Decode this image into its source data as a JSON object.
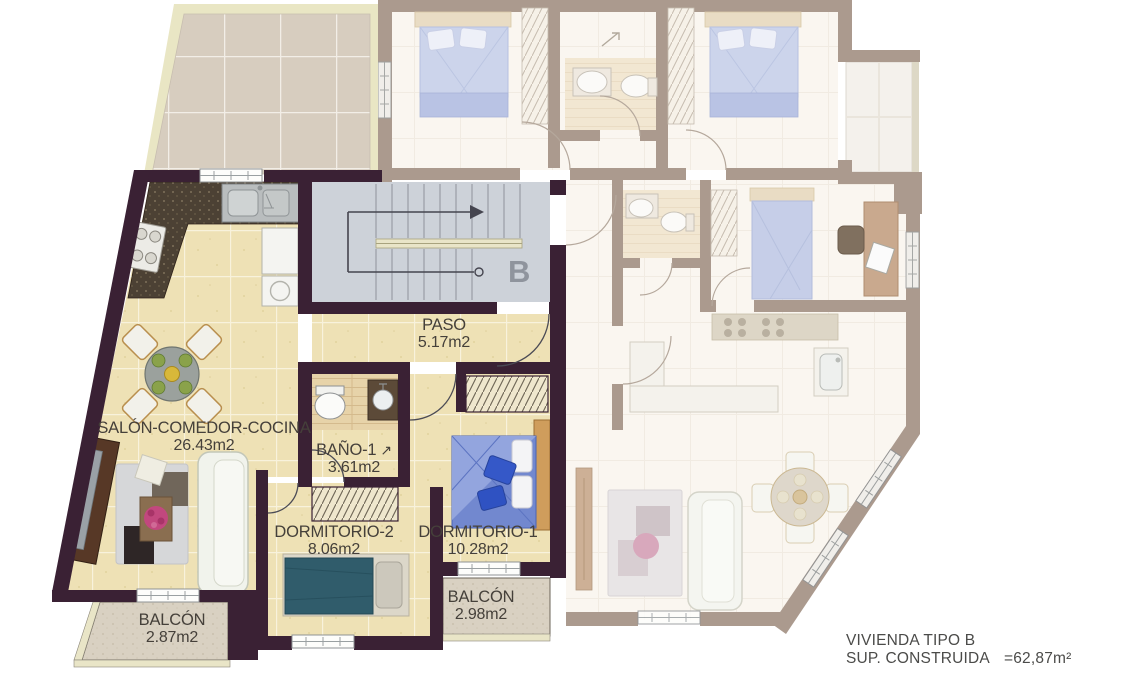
{
  "unit": {
    "letter": "B"
  },
  "rooms": [
    {
      "id": "salon",
      "name": "SALÓN-COMEDOR-COCINA",
      "area": "26.43m2"
    },
    {
      "id": "paso",
      "name": "PASO",
      "area": "5.17m2"
    },
    {
      "id": "bano1",
      "name": "BAÑO-1",
      "area": "3.61m2"
    },
    {
      "id": "dormitorio2",
      "name": "DORMITORIO-2",
      "area": "8.06m2"
    },
    {
      "id": "dormitorio1",
      "name": "DORMITORIO-1",
      "area": "10.28m2"
    },
    {
      "id": "balcon_izq",
      "name": "BALCÓN",
      "area": "2.87m2"
    },
    {
      "id": "balcon_der",
      "name": "BALCÓN",
      "area": "2.98m2"
    }
  ],
  "icons": {
    "bano_door_swing": "↗"
  },
  "title_block": {
    "line1": "VIVIENDA TIPO B",
    "sup_label": "SUP. CONSTRUIDA",
    "sup_value": "=62,87m²"
  },
  "colors": {
    "wall_main": "#3a2134",
    "wall_neighbor": "#ab9a8e",
    "floor_main": "#eee1b5",
    "terrace_tile": "#d7cdbf",
    "stairwell": "#cdd2d9",
    "balcony": "#d9d1c2",
    "bed_teal": "#305c6b",
    "bed_blue": "#7288cf"
  }
}
